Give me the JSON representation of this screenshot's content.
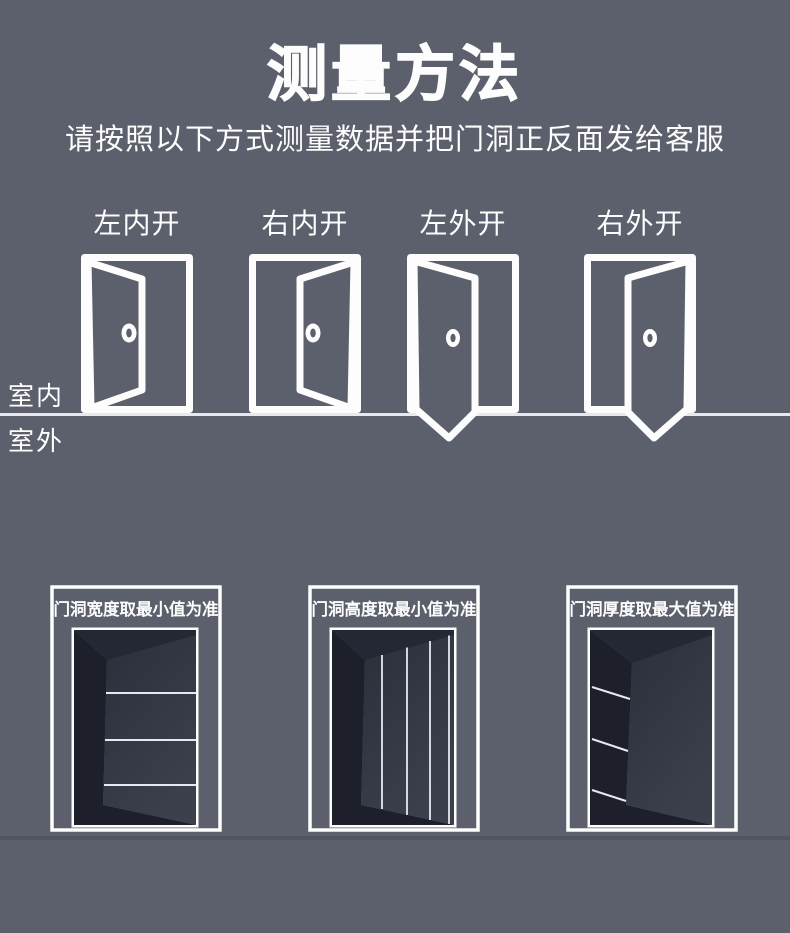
{
  "page": {
    "title": "测量方法",
    "subtitle": "请按照以下方式测量数据并把门洞正反面发给客服",
    "indoor_label": "室内",
    "outdoor_label": "室外"
  },
  "door_types": [
    {
      "label": "左内开"
    },
    {
      "label": "右内开"
    },
    {
      "label": "左外开"
    },
    {
      "label": "右外开"
    }
  ],
  "measurement_panels": [
    {
      "label": "门洞宽度取最小值为准"
    },
    {
      "label": "门洞高度取最小值为准"
    },
    {
      "label": "门洞厚度取最大值为准"
    }
  ],
  "colors": {
    "background": "#5c606c",
    "foreground": "#fdfdfd",
    "divider": "#e8e9ec",
    "doorway_jamb": "#1d202a",
    "doorway_header": "#242834",
    "doorway_face_top": "#2b2f3a",
    "doorway_face_bottom": "#3c404d"
  }
}
